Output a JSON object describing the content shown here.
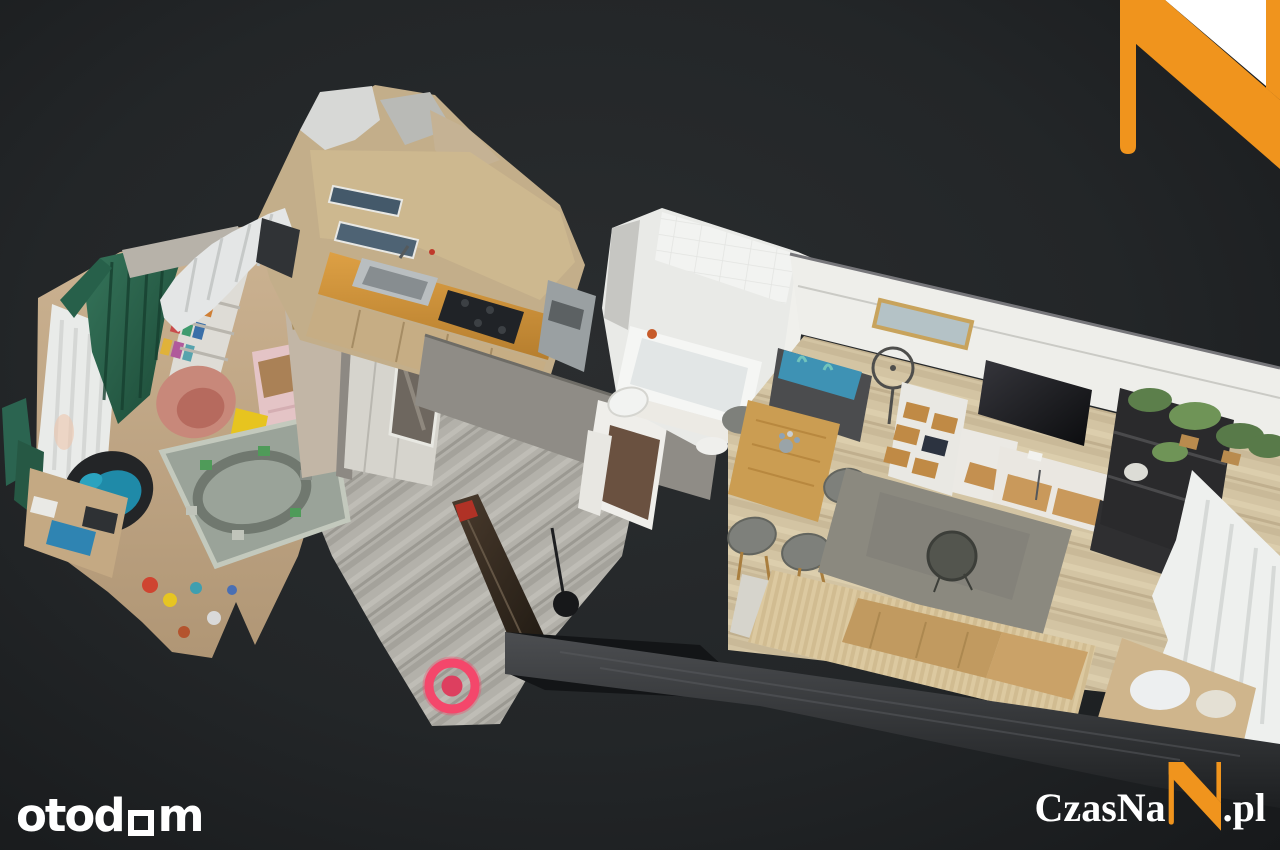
{
  "scene": {
    "background_color": "#232628",
    "marker_color": "#f4476b"
  },
  "branding": {
    "otodom": {
      "prefix": "otod",
      "suffix": "m"
    },
    "czasnan": {
      "prefix": "CzasNa",
      "suffix": ".pl"
    },
    "accent_orange": "#f0941d"
  }
}
